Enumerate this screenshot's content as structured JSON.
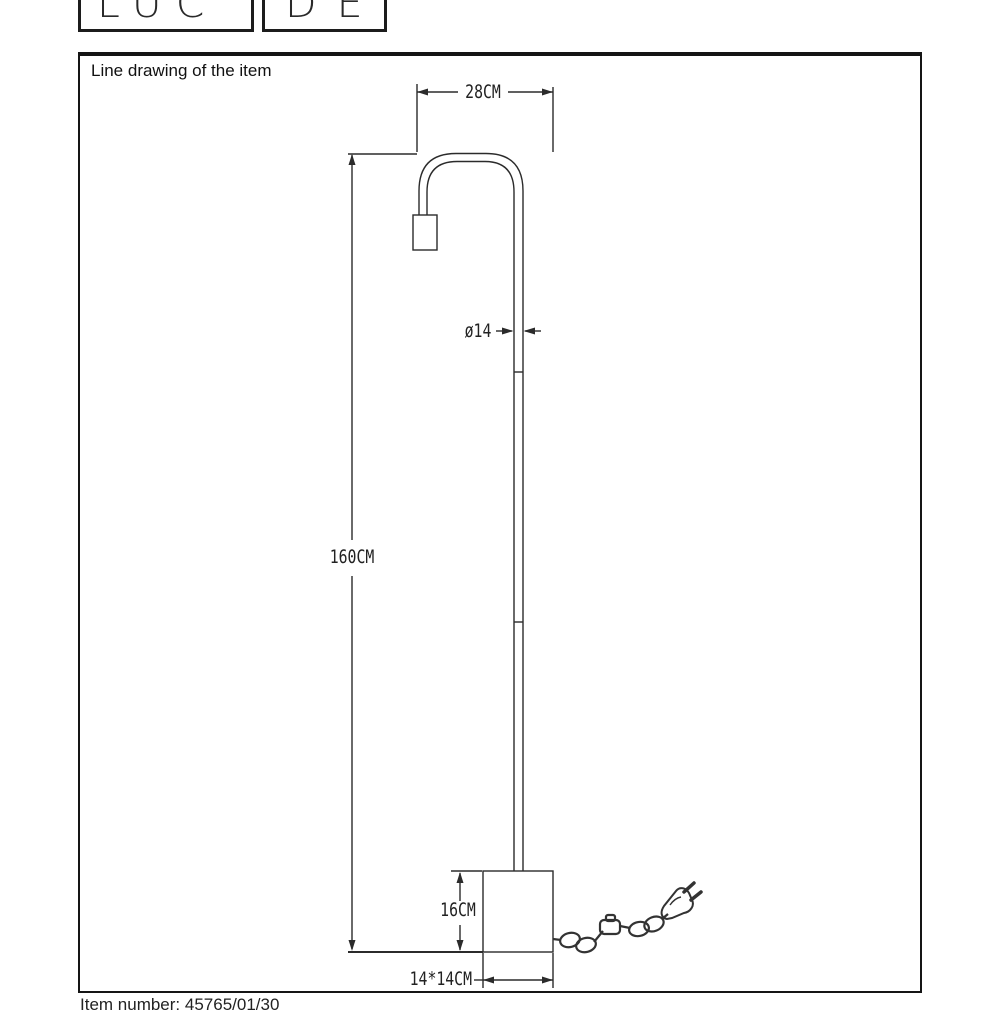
{
  "brand": {
    "logo_part1": "LUC",
    "logo_part2": "DE"
  },
  "panel": {
    "title": "Line drawing of the item"
  },
  "drawing": {
    "type": "technical-line-drawing",
    "item": "floor-lamp",
    "labels": {
      "arm_width": "28CM",
      "pole_diameter": "ø14",
      "total_height": "160CM",
      "base_height": "16CM",
      "base_footprint": "14*14CM"
    }
  },
  "footer": {
    "partial_text": "Item number: 45765/01/30"
  },
  "colors": {
    "line": "#2b2b2b",
    "frame_border": "#151515",
    "background": "#ffffff"
  }
}
